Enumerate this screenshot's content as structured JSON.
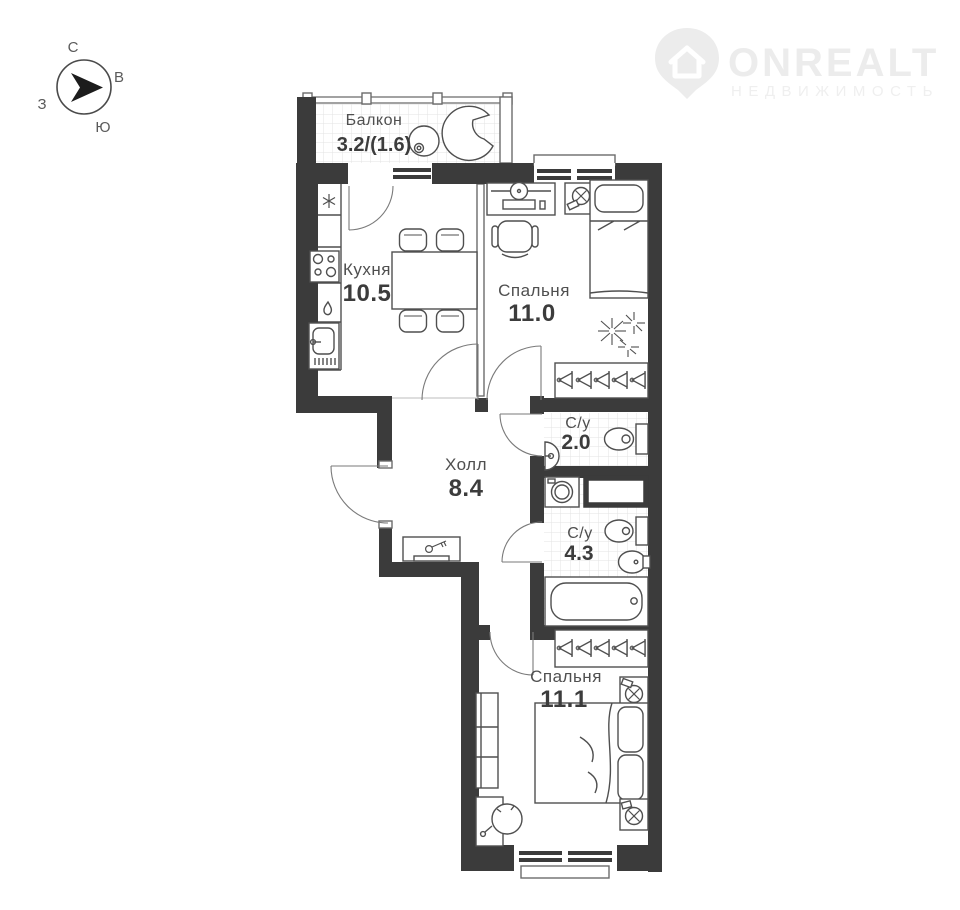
{
  "compass": {
    "north": "С",
    "east": "В",
    "west": "З",
    "south": "Ю"
  },
  "logo": {
    "name": "ONREALT",
    "subtitle": "НЕДВИЖИМОСТЬ"
  },
  "rooms": {
    "balcony": {
      "name": "Балкон",
      "area": "3.2/(1.6)"
    },
    "kitchen": {
      "name": "Кухня",
      "area": "10.5"
    },
    "bedroom1": {
      "name": "Спальня",
      "area": "11.0"
    },
    "bathroom1": {
      "name": "С/у",
      "area": "2.0"
    },
    "hall": {
      "name": "Холл",
      "area": "8.4"
    },
    "bathroom2": {
      "name": "С/у",
      "area": "4.3"
    },
    "bedroom2": {
      "name": "Спальня",
      "area": "11.1"
    }
  },
  "colors": {
    "wall": "#3b3b3b",
    "furniture_line": "#4f4f4f",
    "tile_grid": "#e3e3e3",
    "label": "#4a4a4a",
    "logo": "#ececec"
  }
}
